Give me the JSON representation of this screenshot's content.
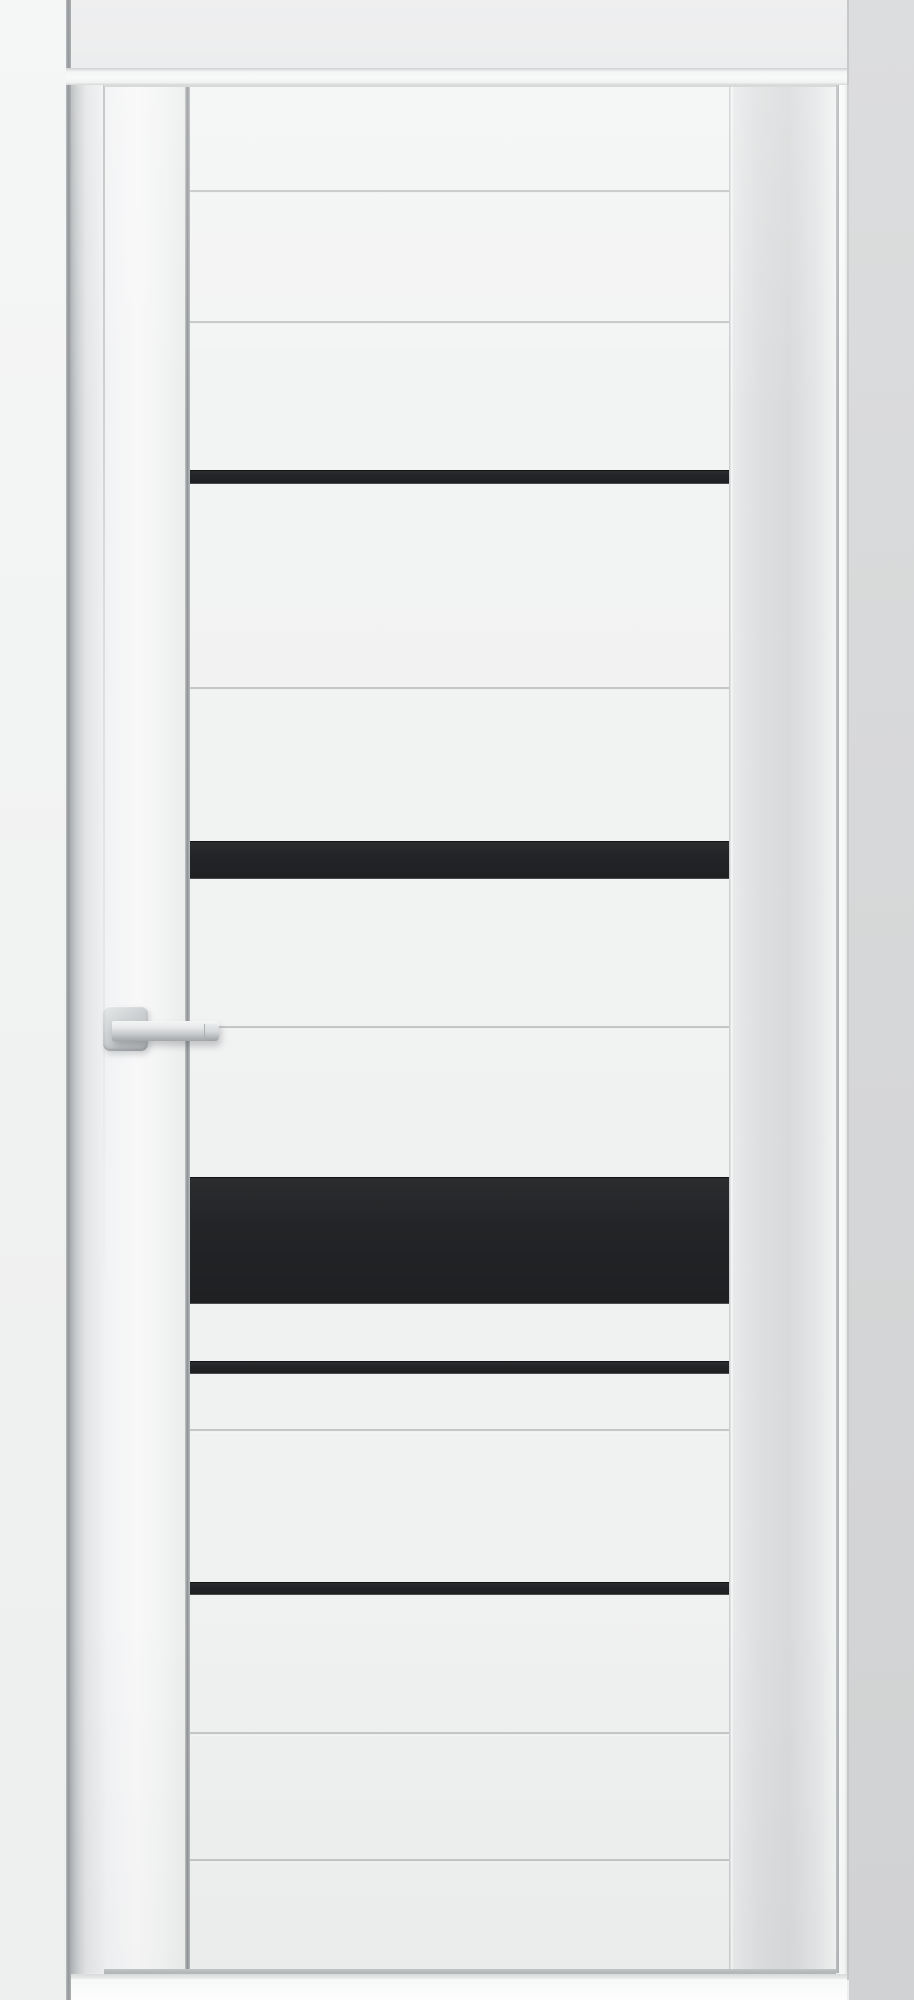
{
  "scene": {
    "type": "product-photo",
    "subject": "Closed white interior door with five horizontal black glass inserts, thin milled grooves, square-rosette chrome lever handle, white frame and light gray walls"
  },
  "canvas": {
    "width": 914,
    "height": 2000
  },
  "palette": {
    "wall_left": "#f2f3f3",
    "wall_above": "#edeeee",
    "wall_right": "#d6d7d8",
    "casing_white": "#f6f7f7",
    "door_panel_white": "#f1f2f2",
    "right_stile_shade": "#dadbdc",
    "glass_stripe_black": "#232427",
    "groove_gray": "#c4c6c7",
    "handle_chrome": "#c9ccce",
    "floor_white": "#fdfdfd"
  },
  "door": {
    "slab_left": 104,
    "slab_top": 85,
    "slab_right": 836,
    "slab_bottom": 1972,
    "glass_x": 190,
    "glass_width": 539
  },
  "glass_stripes": [
    {
      "y": 470,
      "height": 14
    },
    {
      "y": 841,
      "height": 38
    },
    {
      "y": 1177,
      "height": 127
    },
    {
      "y": 1361,
      "height": 13
    },
    {
      "y": 1582,
      "height": 13
    }
  ],
  "grooves": [
    190,
    321,
    687,
    1026,
    1429,
    1732,
    1859
  ],
  "handle": {
    "style": "square rosette with straight lever, satin chrome",
    "rosette": {
      "x": 103,
      "y": 1006,
      "size": 45
    },
    "rose_circle": {
      "x": 106,
      "y": 1012,
      "size": 38
    },
    "lever": {
      "x": 112,
      "y": 1021,
      "length": 107,
      "thickness": 20
    },
    "lever_cap": {
      "x": 204,
      "y": 1024,
      "length": 15,
      "thickness": 17
    }
  }
}
